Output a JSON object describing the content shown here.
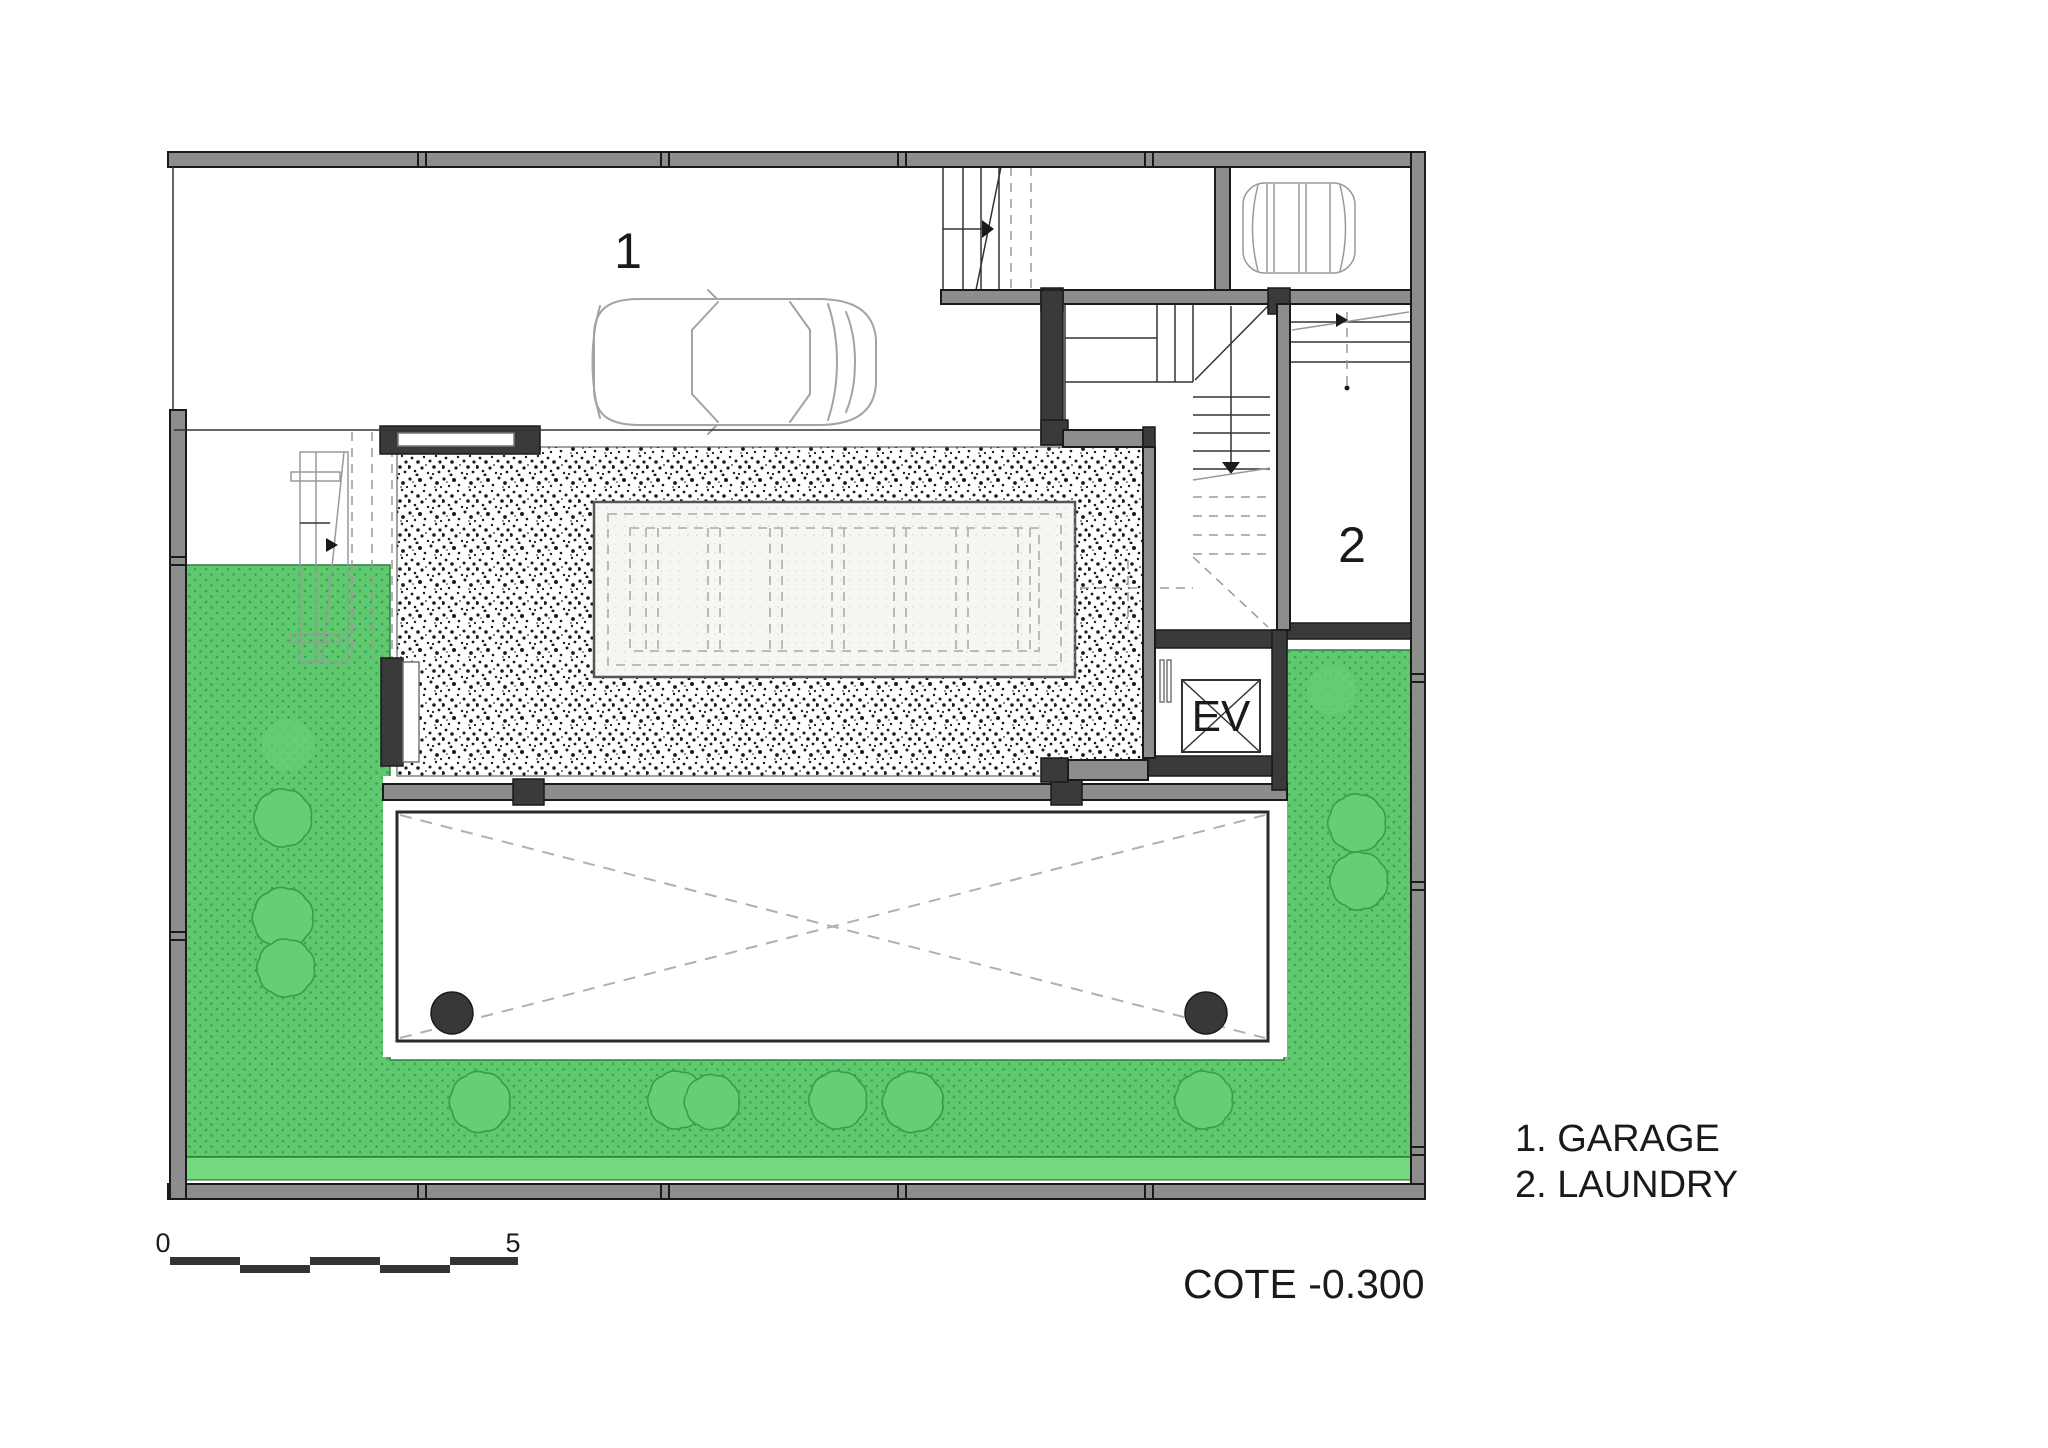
{
  "plan": {
    "rooms": {
      "garage_label": "1",
      "laundry_label": "2",
      "elevator_label": "EV"
    },
    "legend": {
      "items": [
        {
          "text": "1. GARAGE"
        },
        {
          "text": "2. LAUNDRY"
        }
      ]
    },
    "elevation_label": "COTE -0.300",
    "scale_bar": {
      "start": "0",
      "end": "5"
    }
  },
  "colors": {
    "ink": "#1a1a1a",
    "wall": "#8d8d8d",
    "wall_dark": "#3a3a3a",
    "grass": "#5ec96e",
    "grass_dot": "#3da253",
    "grass_light": "#72d97f",
    "grass_edge": "#2e7d3b",
    "shrub": "#66cf74",
    "shrub_edge": "#3d9a4e",
    "skylight": "#f6f6f2",
    "skylight_dot": "#d8d8cf",
    "column": "#383838",
    "car_line": "#a3a3a3",
    "paper": "#ffffff"
  }
}
